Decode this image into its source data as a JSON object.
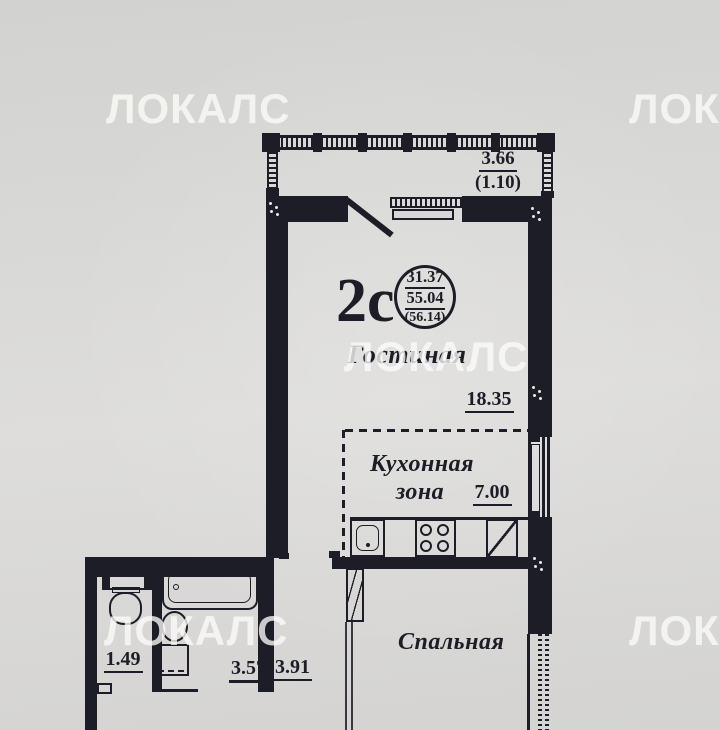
{
  "brand_watermark": "ЛОКАЛС",
  "plan": {
    "balcony": {
      "length_m": "3.66",
      "area_m2": "(1.10)"
    },
    "unit_stamp": {
      "unit_type": "2с",
      "living_area": "31.37",
      "total_area": "55.04",
      "total_area_with_balcony": "(56.14)"
    },
    "living_room": {
      "name": "Гостиная",
      "area_m2": "18.35"
    },
    "kitchen_zone": {
      "name": "Кухонная зона",
      "area_m2": "7.00"
    },
    "bedroom": {
      "name": "Спальная"
    },
    "wc": {
      "area_m2": "1.49"
    },
    "bathroom": {
      "area_m2": "3.57"
    },
    "hallway": {
      "area_m2": "3.91"
    }
  },
  "colors": {
    "ink": "#1d1d27",
    "paper": "#d8d7d5",
    "watermark": "#fbfbf9"
  }
}
